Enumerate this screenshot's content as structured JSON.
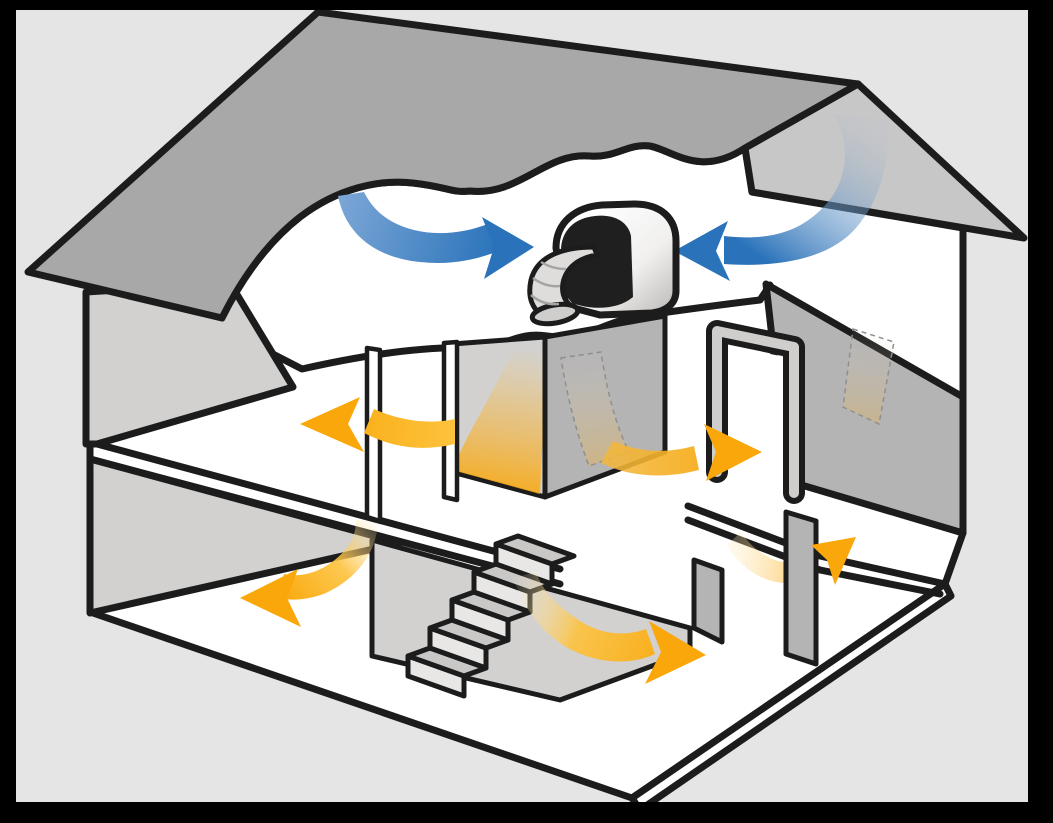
{
  "diagram": {
    "label": "Cutaway illustration of a two-story house: a whole-house fan in the attic pulls warm air (yellow arrows) up through doorways and the stairwell while cool air (blue arrows) is drawn across the attic into the fan",
    "scene": "two-story house cross-section with attic fan and airflow arrows",
    "has_text": false
  },
  "palette": {
    "frame": "#000000",
    "canvas": "#e6e5e5",
    "outline": "#1c1c1c",
    "roof": "#a9a8a8",
    "roof_far": "#c8c7c7",
    "wall": "#b5b4b4",
    "wall_inner": "#d2d1d0",
    "floor": "#ffffff",
    "step_riser": "#e8e7e6",
    "step_tread": "#c9c8c7",
    "duct": "#dedddc",
    "fan_face": "#1f1f1f",
    "cool_air": "#2a73ba",
    "cool_air_light": "#7ba6d6",
    "warm_air": "#f9a70a",
    "warm_air_light": "#fdc23d"
  },
  "components": {
    "fan_unit": {
      "label": "attic fan unit with flexible duct",
      "location": "center of attic floor"
    },
    "staircase": {
      "label": "staircase",
      "steps": 5,
      "location": "first floor center"
    },
    "floors": [
      "first floor",
      "second floor",
      "attic"
    ],
    "doorways": [
      {
        "label": "second floor left doorway"
      },
      {
        "label": "second floor right doorway"
      },
      {
        "label": "first floor right doorway"
      }
    ]
  },
  "airflows": {
    "cool": [
      {
        "label": "cool air stream curving right across the attic into the fan"
      },
      {
        "label": "cool air entering under the right eave and curving left into the fan"
      }
    ],
    "warm": [
      {
        "label": "warm air arrow through second-floor left doorway pointing left"
      },
      {
        "label": "warm air rising ribbon behind second-floor hall wall"
      },
      {
        "label": "warm air arrow through second-floor right doorway pointing right"
      },
      {
        "label": "warm air arrow on first floor curving down to the left"
      },
      {
        "label": "warm air arrow on first floor curving right past the staircase"
      },
      {
        "label": "warm air arrow on first floor rising through the right doorway"
      }
    ]
  }
}
